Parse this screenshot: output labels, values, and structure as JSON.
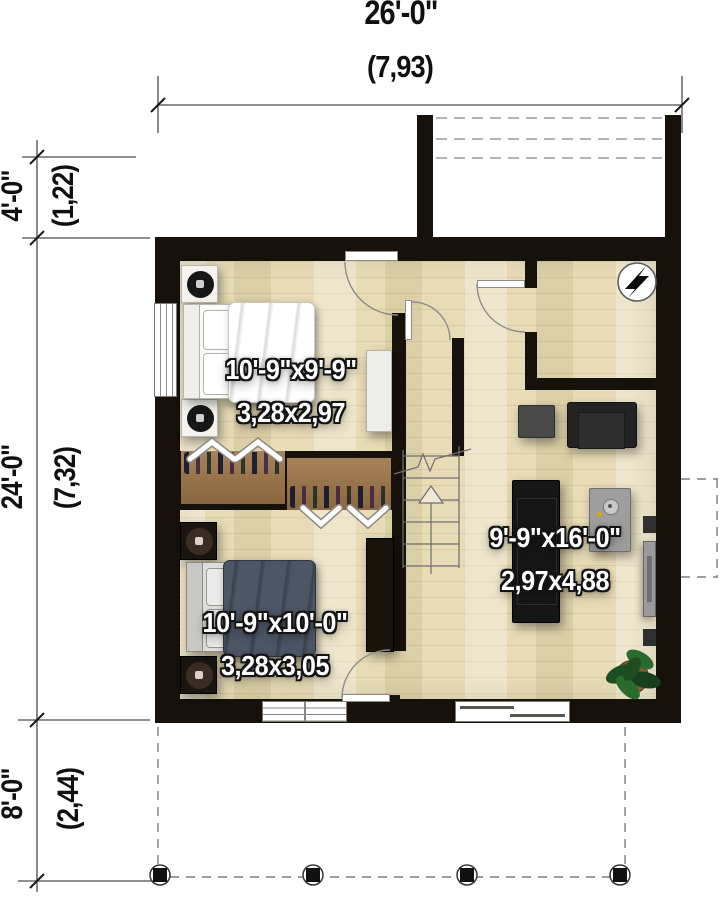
{
  "dimensions": {
    "top": {
      "feet": "26'-0\"",
      "meters": "(7,93)"
    },
    "left": [
      {
        "feet": "4'-0\"",
        "meters": "(1,22)"
      },
      {
        "feet": "24'-0\"",
        "meters": "(7,32)"
      },
      {
        "feet": "8'-0\"",
        "meters": "(2,44)"
      }
    ]
  },
  "rooms": [
    {
      "id": "bedroom-1",
      "imperial": "10'-9\"x9'-9\"",
      "metric": "3,28x2,97"
    },
    {
      "id": "bedroom-2",
      "imperial": "10'-9\"x10'-0\"",
      "metric": "3,28x3,05"
    },
    {
      "id": "living-area",
      "imperial": "9'-9\"x16'-0\"",
      "metric": "2,97x4,88"
    }
  ],
  "icons": {
    "electrical_panel": "lightning-bolt"
  },
  "colors": {
    "wall": "#16110b",
    "floor_base": "#e7dcb6",
    "floor_light": "#f2ecd4",
    "closet_wood": "#9a7549",
    "bed2_duvet": "#4d5666",
    "dimension_text": "#101010",
    "room_label_fill": "#ffffff",
    "room_label_outline": "#141414",
    "plant_green": "#1e4d22"
  }
}
